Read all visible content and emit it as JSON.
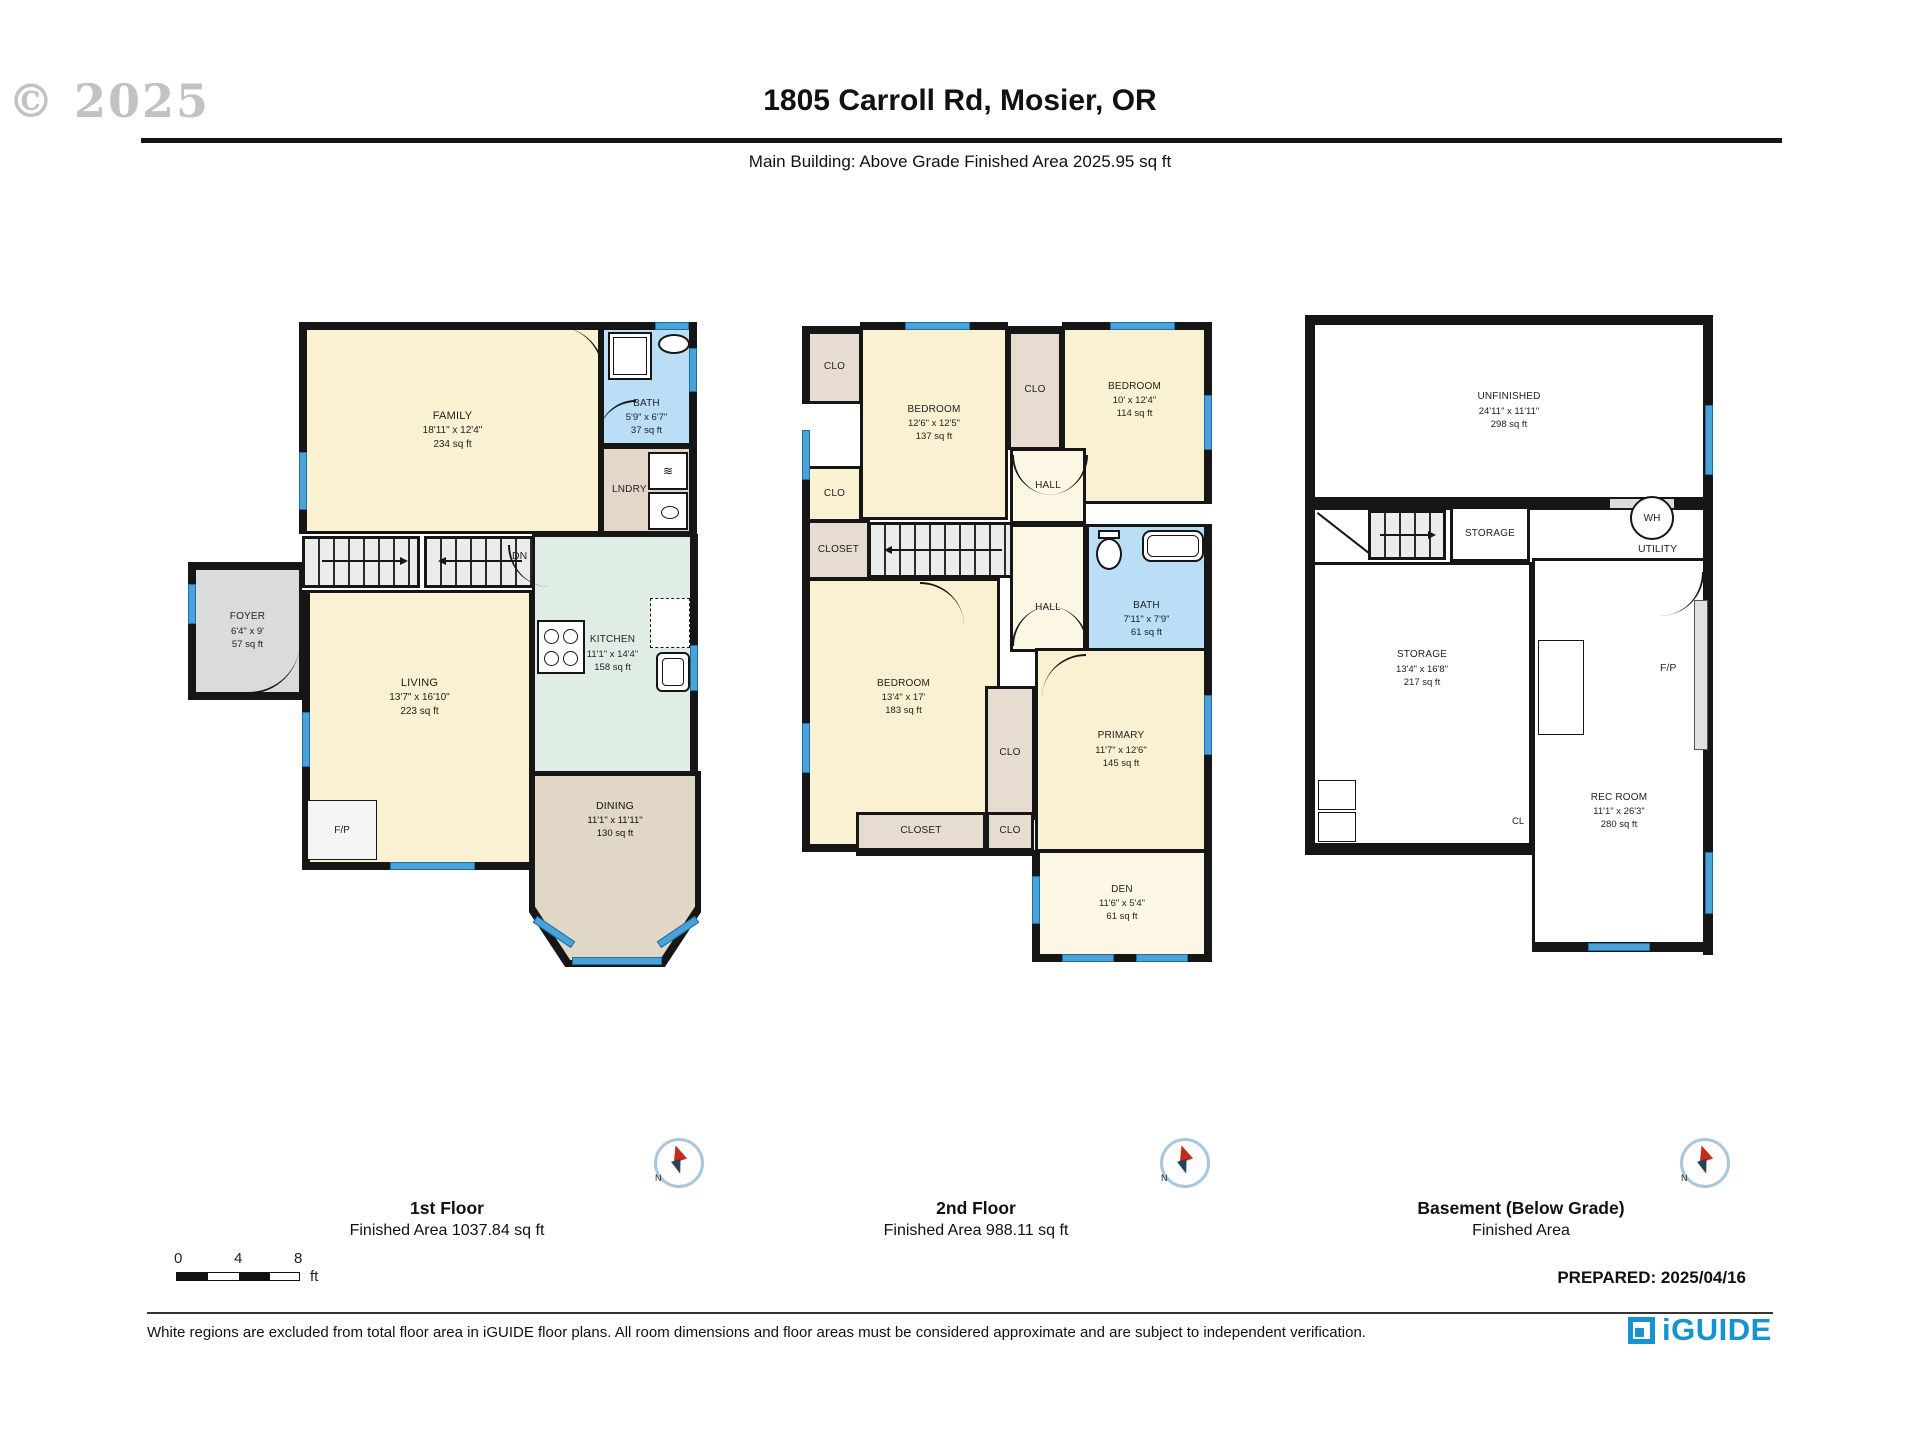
{
  "header": {
    "watermark": "© 2025",
    "title": "1805 Carroll Rd, Mosier, OR",
    "subtitle": "Main Building: Above Grade Finished Area 2025.95 sq ft"
  },
  "plan1": {
    "family": {
      "name": "FAMILY",
      "dims": "18'11\" x 12'4\"",
      "area": "234 sq ft"
    },
    "bath": {
      "name": "BATH",
      "dims": "5'9\" x 6'7\"",
      "area": "37 sq ft"
    },
    "lndry": {
      "name": "LNDRY"
    },
    "foyer": {
      "name": "FOYER",
      "dims": "6'4\" x 9'",
      "area": "57 sq ft"
    },
    "living": {
      "name": "LIVING",
      "dims": "13'7\" x 16'10\"",
      "area": "223 sq ft"
    },
    "kitchen": {
      "name": "KITCHEN",
      "dims": "11'1\" x 14'4\"",
      "area": "158 sq ft"
    },
    "dining": {
      "name": "DINING",
      "dims": "11'1\" x 11'11\"",
      "area": "130 sq ft"
    },
    "up": "UP",
    "dn": "DN",
    "fp": "F/P"
  },
  "plan2": {
    "bedroom1": {
      "name": "BEDROOM",
      "dims": "12'6\" x 12'5\"",
      "area": "137 sq ft"
    },
    "bedroom2": {
      "name": "BEDROOM",
      "dims": "10' x 12'4\"",
      "area": "114 sq ft"
    },
    "bedroom3": {
      "name": "BEDROOM",
      "dims": "13'4\" x 17'",
      "area": "183 sq ft"
    },
    "primary": {
      "name": "PRIMARY",
      "dims": "11'7\" x 12'6\"",
      "area": "145 sq ft"
    },
    "bath": {
      "name": "BATH",
      "dims": "7'11\" x 7'9\"",
      "area": "61 sq ft"
    },
    "den": {
      "name": "DEN",
      "dims": "11'6\" x 5'4\"",
      "area": "61 sq ft"
    },
    "clo": "CLO",
    "closet": "CLOSET",
    "hall": "HALL",
    "dn": "DN"
  },
  "plan3": {
    "unfinished": {
      "name": "UNFINISHED",
      "dims": "24'11\" x 11'11\"",
      "area": "298 sq ft"
    },
    "storage_small": {
      "name": "STORAGE"
    },
    "storage": {
      "name": "STORAGE",
      "dims": "13'4\" x 16'8\"",
      "area": "217 sq ft"
    },
    "recroom": {
      "name": "REC ROOM",
      "dims": "11'1\" x 26'3\"",
      "area": "280 sq ft"
    },
    "up": "UP",
    "wh": "WH",
    "utility": "UTILITY",
    "fp": "F/P",
    "cl": "CL"
  },
  "floors": [
    {
      "label": "1st Floor",
      "area": "Finished Area 1037.84 sq ft"
    },
    {
      "label": "2nd Floor",
      "area": "Finished Area 988.11 sq ft"
    },
    {
      "label": "Basement (Below Grade)",
      "area": "Finished Area"
    }
  ],
  "compass_label": "N",
  "scalebar": {
    "t0": "0",
    "t1": "4",
    "t2": "8",
    "unit": "ft"
  },
  "prepared": "PREPARED: 2025/04/16",
  "footer": {
    "disclaimer": "White regions are excluded from total floor area in iGUIDE floor plans. All room dimensions and floor areas must be considered approximate and are subject to independent verification.",
    "brand": "iGUIDE"
  },
  "colors": {
    "accent": "#1793CE",
    "wall": "#161616",
    "window": "#4AA2D9"
  }
}
